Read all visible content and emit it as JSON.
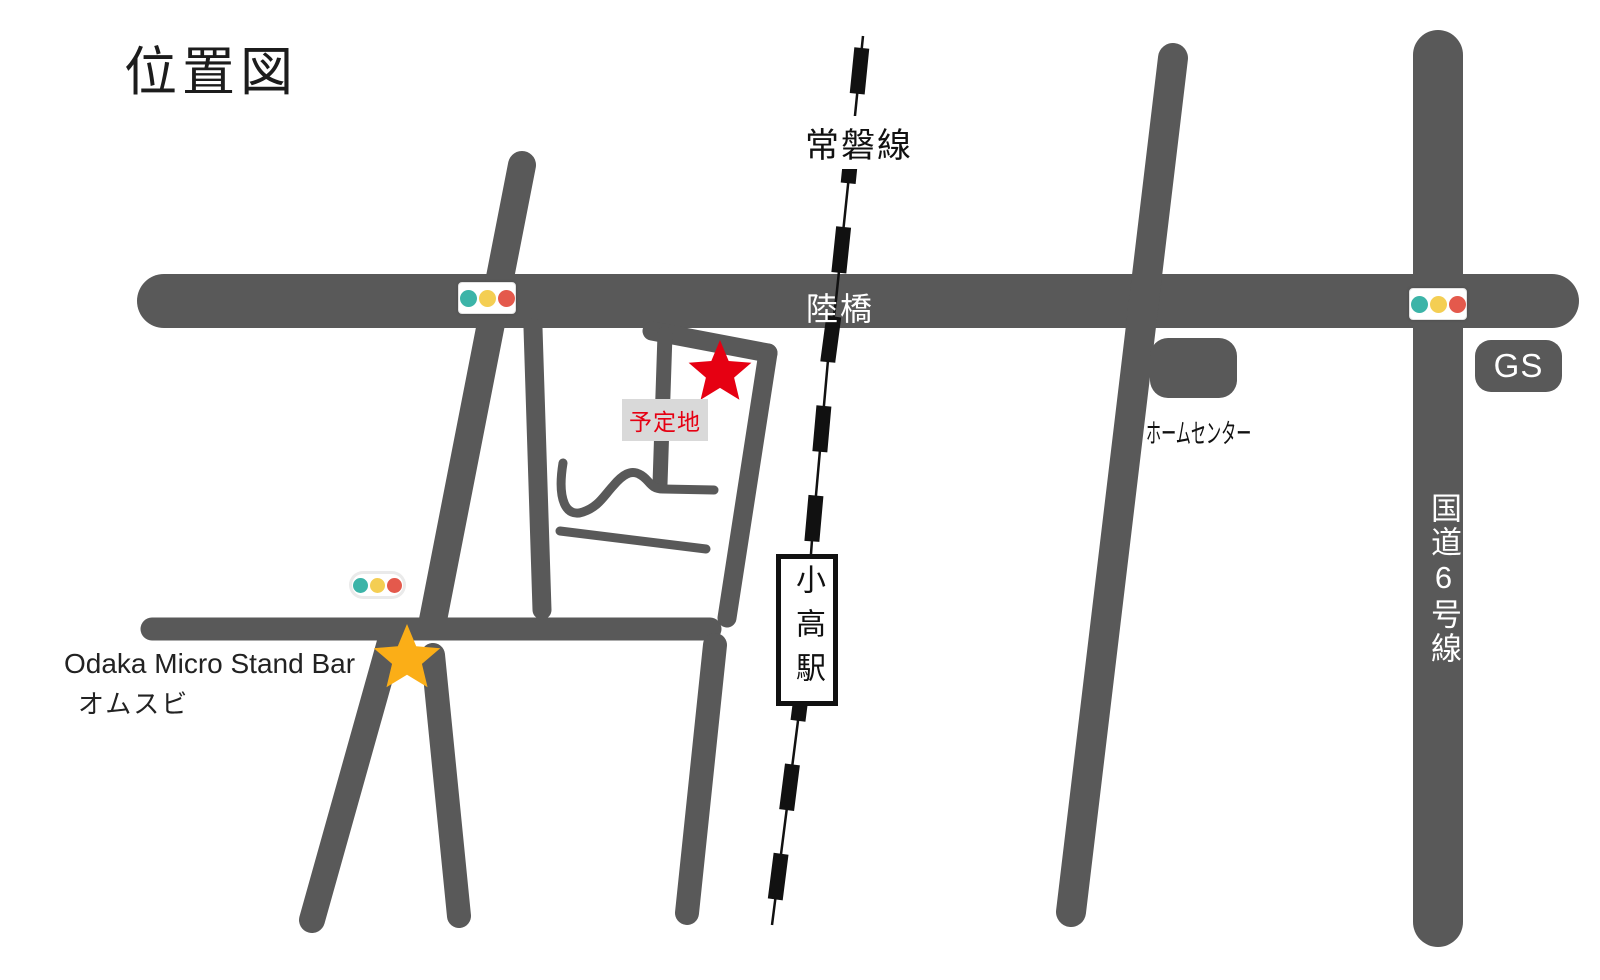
{
  "title": "位置図",
  "colors": {
    "road": "#595959",
    "railway": "#111111",
    "accent_red": "#e60012",
    "star_gold": "#FBAE17",
    "label_bg": "#d9d9d9",
    "signal_teal": "#3CB4A8",
    "signal_yellow": "#F4CE53",
    "signal_red": "#E4594C"
  },
  "labels": {
    "railway_line": "常磐線",
    "overpass": "陸橋",
    "route6": "国道6号線",
    "gas_station": "GS",
    "home_center": "ホームセンター",
    "station": "小高駅",
    "planned_site": "予定地",
    "shop_name_en": "Odaka Micro Stand Bar",
    "shop_name_jp": "オムスビ"
  }
}
